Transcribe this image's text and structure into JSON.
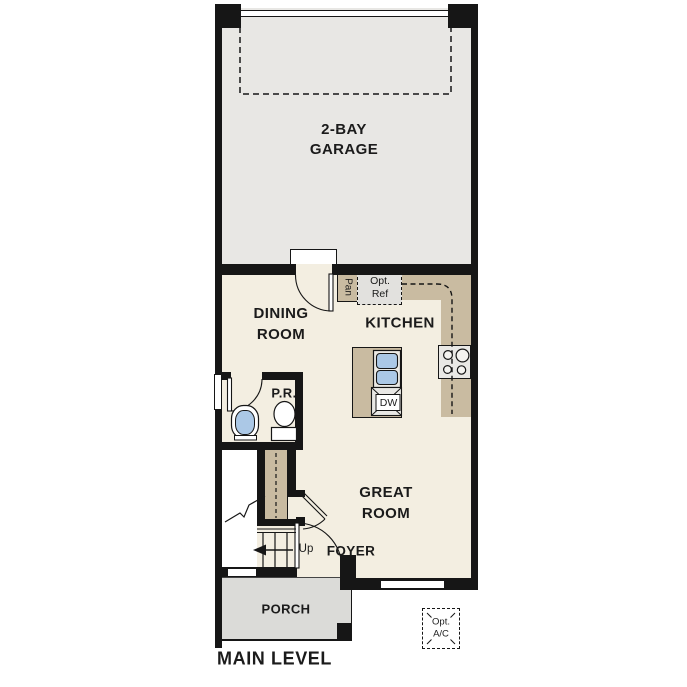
{
  "plan": {
    "title": "MAIN LEVEL",
    "rooms": {
      "garage": {
        "line1": "2-BAY",
        "line2": "GARAGE"
      },
      "dining_room": {
        "line1": "DINING",
        "line2": "ROOM"
      },
      "kitchen": {
        "label": "KITCHEN"
      },
      "great_room": {
        "line1": "GREAT",
        "line2": "ROOM"
      },
      "powder_room": {
        "label": "P.R."
      },
      "foyer": {
        "label": "FOYER"
      },
      "porch": {
        "label": "PORCH"
      }
    },
    "annotations": {
      "pantry": {
        "label": "Pan"
      },
      "opt_refrigerator": {
        "line1": "Opt.",
        "line2": "Ref"
      },
      "dishwasher": {
        "label": "DW"
      },
      "stair_direction": {
        "label": "Up"
      },
      "opt_ac": {
        "line1": "Opt.",
        "line2": "A/C"
      }
    },
    "colors": {
      "wall": "#161616",
      "interior_floor": "#f3eee1",
      "garage_floor": "#e8e7e4",
      "porch_floor": "#dbdbd8",
      "casework_tan": "#c9bba1",
      "appliance_gray": "#e9e8e5",
      "fixture_blue": "#abc8e6"
    }
  }
}
